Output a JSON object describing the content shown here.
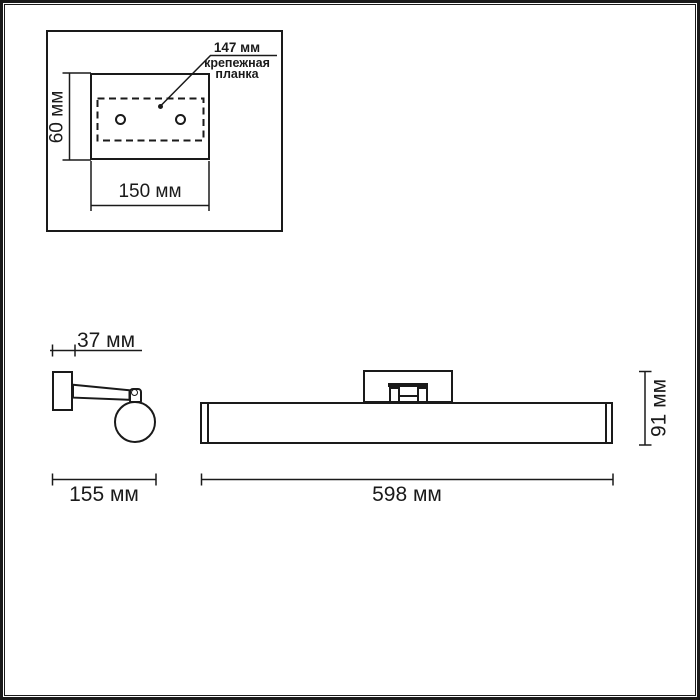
{
  "colors": {
    "line": "#1a1a1a",
    "background": "#ffffff"
  },
  "inset_mounting_plate": {
    "holes_spacing_label": "147 мм",
    "part_name_line1": "крепежная",
    "part_name_line2": "планка",
    "height_label": "60 мм",
    "width_label": "150 мм"
  },
  "side_view": {
    "wall_bracket_depth_label": "37 мм",
    "overall_depth_label": "155 мм"
  },
  "front_view": {
    "overall_length_label": "598 мм",
    "overall_height_label": "91 мм"
  }
}
